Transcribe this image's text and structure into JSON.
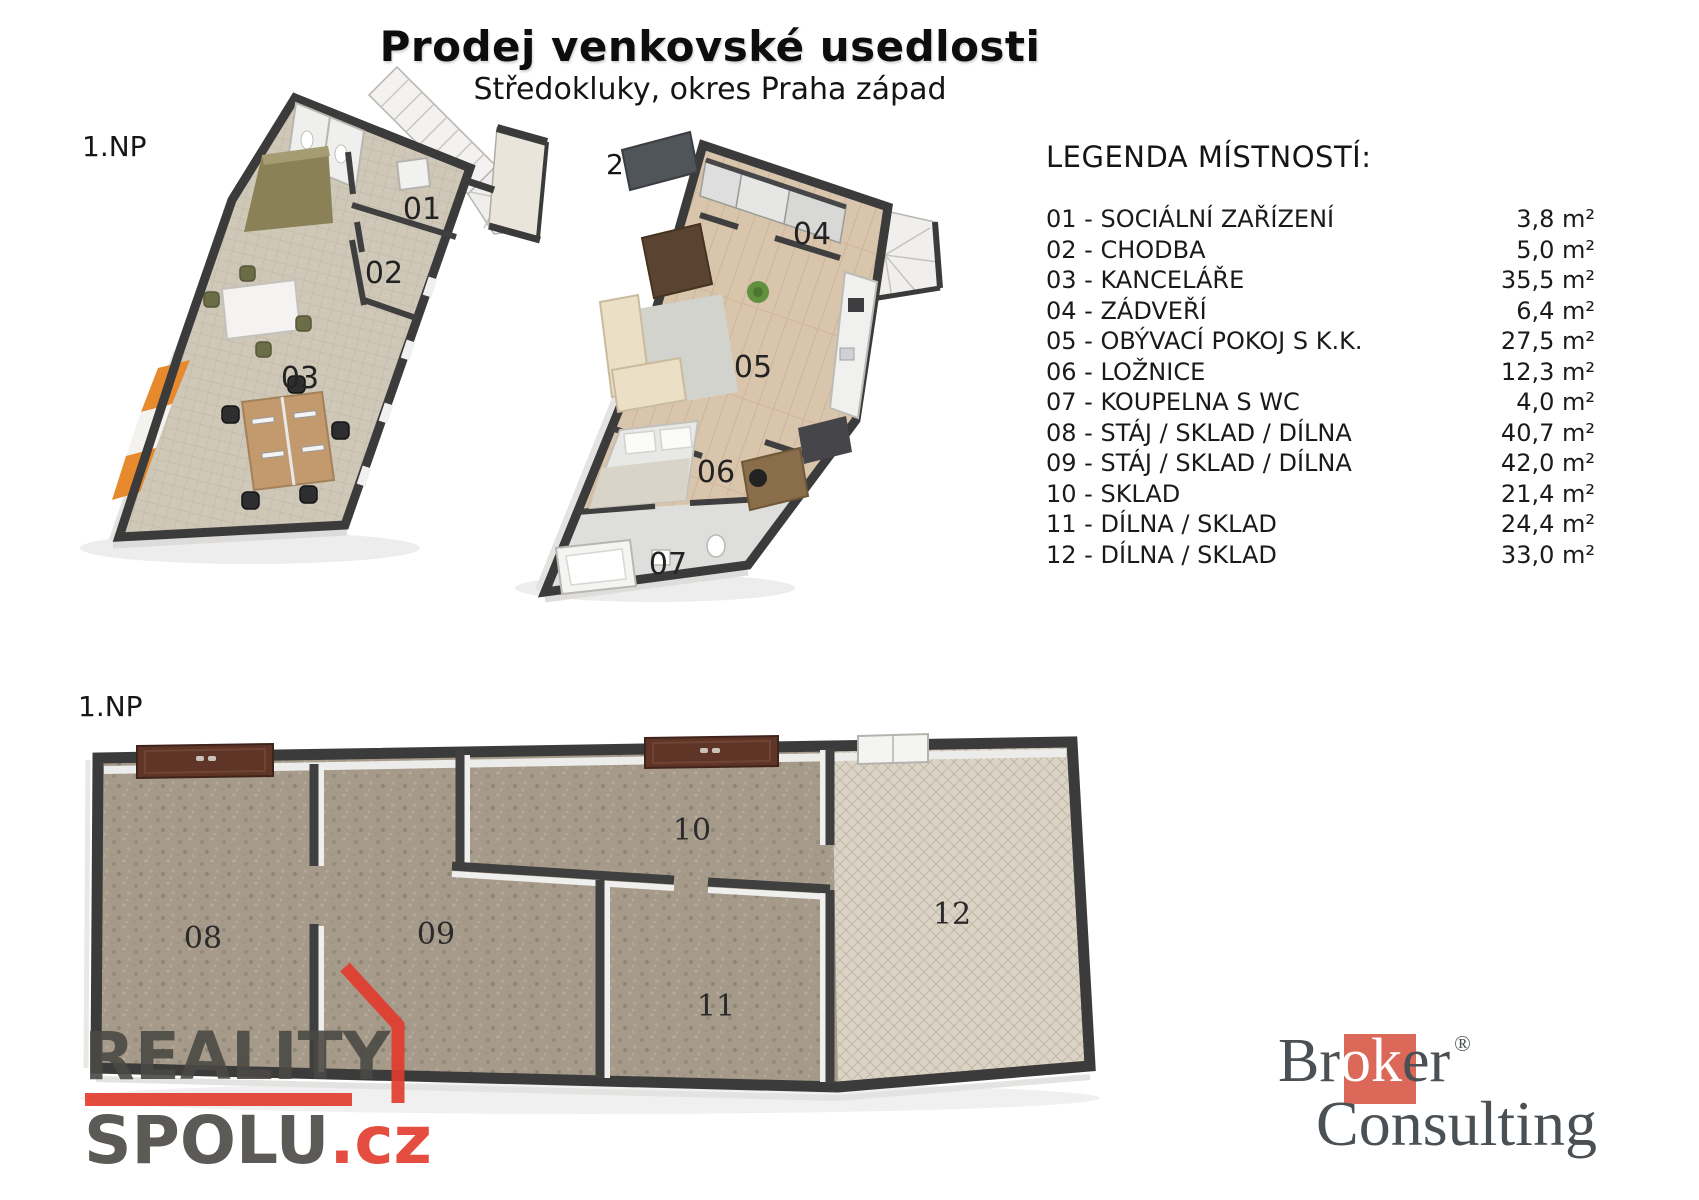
{
  "title": "Prodej venkovské usedlosti",
  "subtitle": "Středokluky, okres Praha západ",
  "plans": {
    "p1": {
      "label": "1.NP",
      "rooms": [
        "01",
        "02",
        "03"
      ]
    },
    "p2": {
      "label": "2.NP",
      "rooms": [
        "04",
        "05",
        "06",
        "07"
      ]
    },
    "p3": {
      "label": "1.NP",
      "rooms": [
        "08",
        "09",
        "10",
        "11",
        "12"
      ]
    }
  },
  "legend": {
    "heading": "LEGENDA MÍSTNOSTÍ:",
    "rooms": [
      {
        "label": "01 - SOCIÁLNÍ ZAŘÍZENÍ",
        "area": "3,8 m²"
      },
      {
        "label": "02 - CHODBA",
        "area": "5,0 m²"
      },
      {
        "label": "03 - KANCELÁŘE",
        "area": "35,5 m²"
      },
      {
        "label": "04 - ZÁDVEŘÍ",
        "area": "6,4 m²"
      },
      {
        "label": "05 - OBÝVACÍ POKOJ S K.K.",
        "area": "27,5 m²"
      },
      {
        "label": "06 - LOŽNICE",
        "area": "12,3 m²"
      },
      {
        "label": "07 - KOUPELNA S WC",
        "area": "4,0 m²"
      },
      {
        "label": "08 - STÁJ / SKLAD / DÍLNA",
        "area": "40,7 m²"
      },
      {
        "label": "09 - STÁJ / SKLAD / DÍLNA",
        "area": "42,0 m²"
      },
      {
        "label": "10 - SKLAD",
        "area": "21,4 m²"
      },
      {
        "label": "11 - DÍLNA / SKLAD",
        "area": "24,4 m²"
      },
      {
        "label": "12 - DÍLNA / SKLAD",
        "area": "33,0 m²"
      }
    ]
  },
  "watermark": {
    "line1": "REALITY",
    "line2": "SPOLU",
    "suffix": ".cz"
  },
  "broker": {
    "part1": "Br",
    "part2": "ok",
    "part3": "er",
    "registered": "®",
    "line2": "Consulting"
  },
  "colors": {
    "accent_orange": "#e8872e",
    "logo_red": "#e23a2c",
    "broker_square": "#dc685a",
    "wall": "#3b3b3b"
  }
}
